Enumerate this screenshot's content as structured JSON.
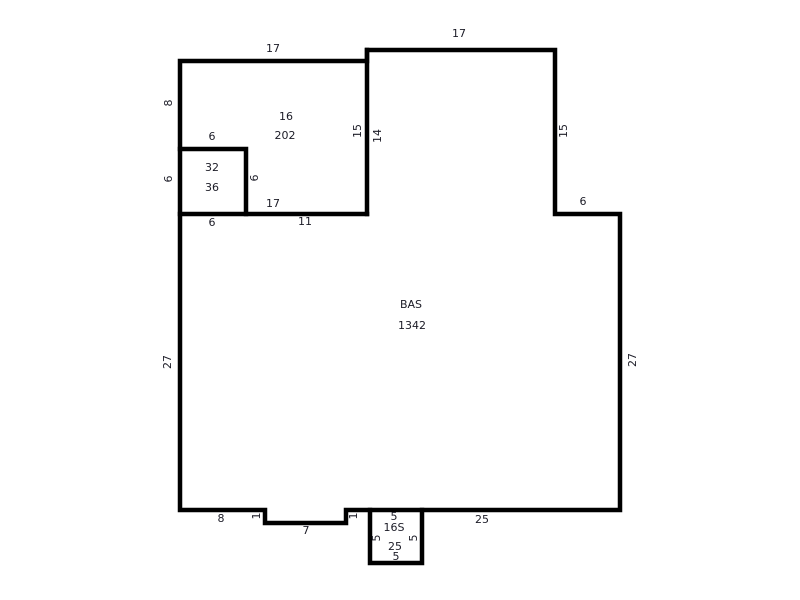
{
  "colors": {
    "background": "#ffffff",
    "walls": "#000000",
    "text": "#1b1b26"
  },
  "rooms": {
    "room16": {
      "code": "16",
      "area": "202"
    },
    "closet": {
      "code": "32",
      "area": "36"
    },
    "bas": {
      "code": "BAS",
      "area": "1342"
    },
    "stoop": {
      "code": "16S",
      "area": "25"
    }
  },
  "dims": {
    "room16_top": "17",
    "room16_left": "8",
    "room16_bottom": "17",
    "upper_right_top": "17",
    "upper_right_right": "15",
    "inner_wall_left": "15",
    "inner_wall_right": "14",
    "closet_top": "6",
    "closet_left": "6",
    "closet_right": "6",
    "closet_bottom": "6",
    "bas_top": "11",
    "right_step": "6",
    "bas_left": "27",
    "bas_right": "27",
    "bottom_left": "8",
    "notch_left": "1",
    "notch_bottom": "7",
    "notch_right": "1",
    "bottom_right": "25",
    "stoop_top": "5",
    "stoop_left": "5",
    "stoop_right": "5",
    "stoop_bottom": "5"
  }
}
